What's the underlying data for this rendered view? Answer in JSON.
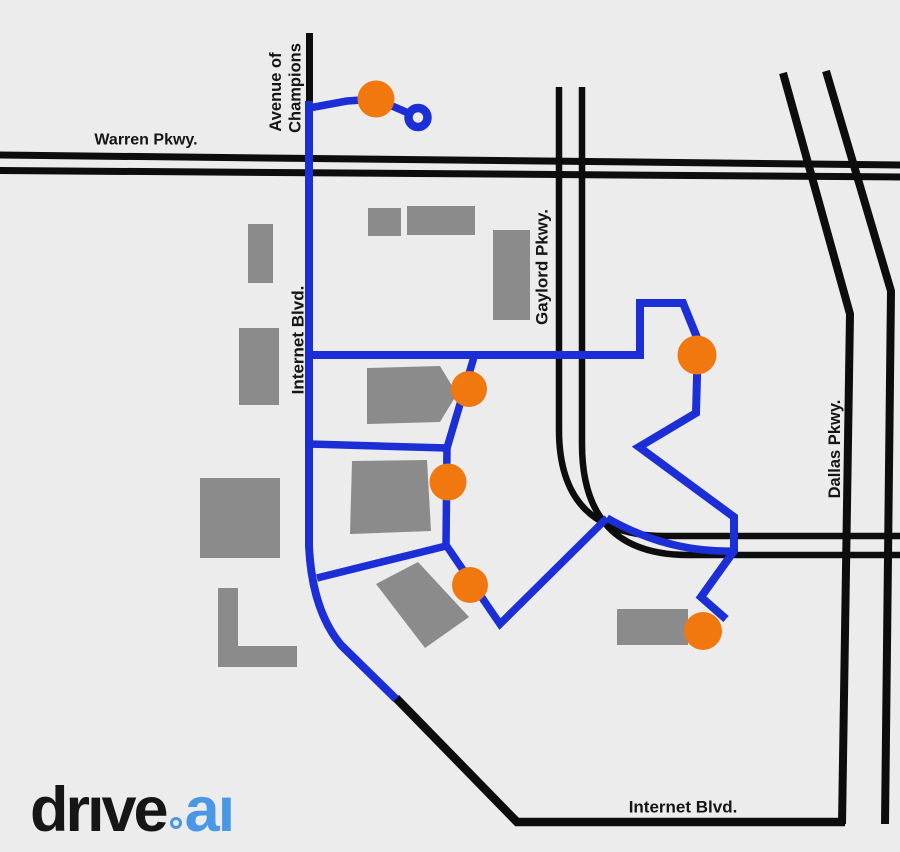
{
  "page": {
    "background": "#ececec"
  },
  "colors": {
    "road": "#0d0d0d",
    "route": "#1c2ed6",
    "stop": "#f0780f",
    "building": "#8b8b8b",
    "label": "#151515",
    "logo_text": "#161616",
    "logo_accent": "#4a97e6"
  },
  "labels": {
    "warren": "Warren Pkwy.",
    "avenue_line1": "Avenue of",
    "avenue_line2": "Champions",
    "internet_west": "Internet Blvd.",
    "gaylord": "Gaylord Pkwy.",
    "dallas": "Dallas Pkwy.",
    "internet_south": "Internet Blvd."
  },
  "map": {
    "stop_count": 6,
    "turnaround_count": 1,
    "building_count": 11
  },
  "logo": {
    "word": "drıve",
    "separator": ".",
    "tld": "aı"
  }
}
